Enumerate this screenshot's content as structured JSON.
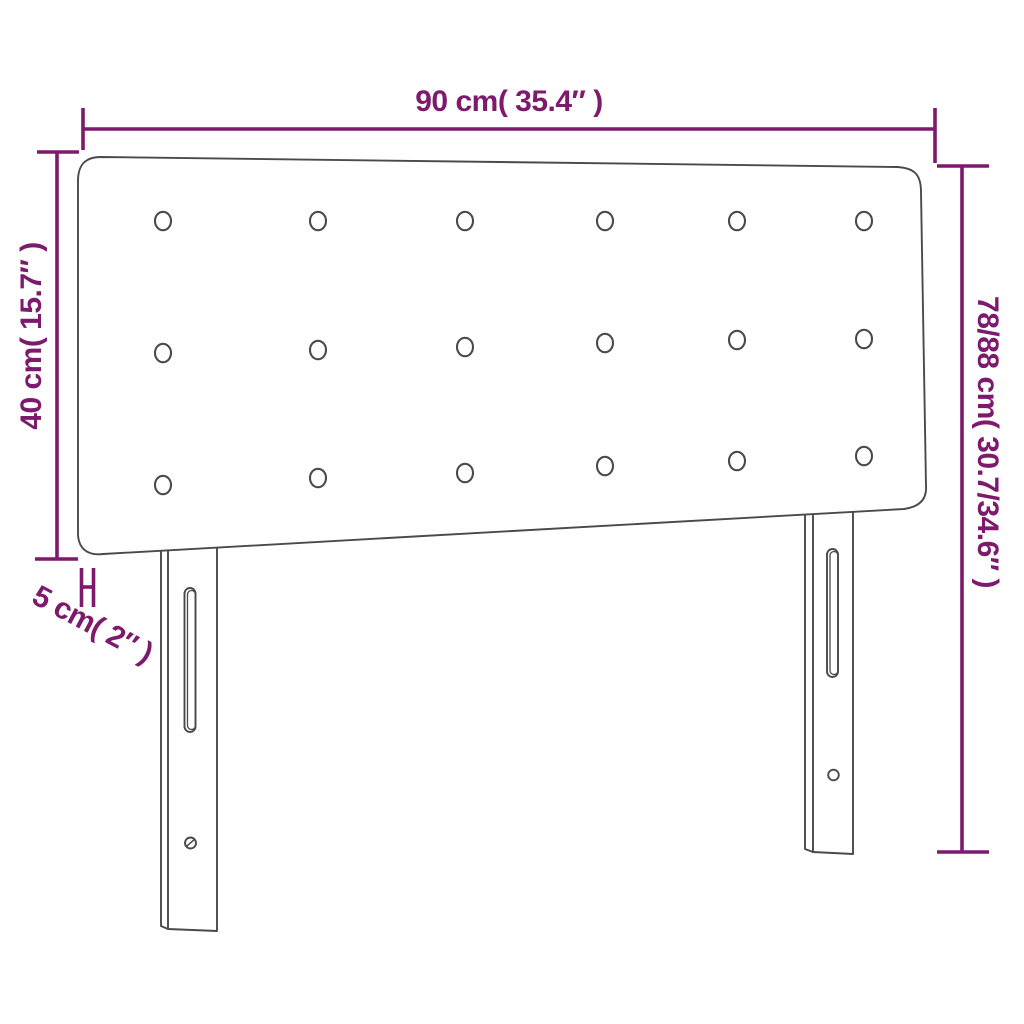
{
  "diagram": {
    "type": "product-dimension-diagram",
    "subject": "upholstered headboard with tufted buttons and two mounting legs",
    "background": "#ffffff",
    "colors": {
      "dimension": "#7d1a6d",
      "outline": "#4a4a4a"
    },
    "labels": {
      "width": "90 cm( 35.4″ )",
      "panel_height": "40 cm( 15.7″ )",
      "total_height": "78/88 cm( 30.7/34.6″ )",
      "thickness": "5 cm( 2″ )"
    },
    "buttons": {
      "rows": 3,
      "cols": 6,
      "rx": 8,
      "ry": 9.2,
      "xs": [
        163,
        318,
        465,
        605,
        737,
        864
      ],
      "row_ys": [
        [
          221,
          221,
          221,
          221,
          221,
          221
        ],
        [
          353,
          350,
          347,
          343,
          340,
          339
        ],
        [
          485,
          478,
          473,
          466,
          461,
          456
        ]
      ]
    }
  }
}
